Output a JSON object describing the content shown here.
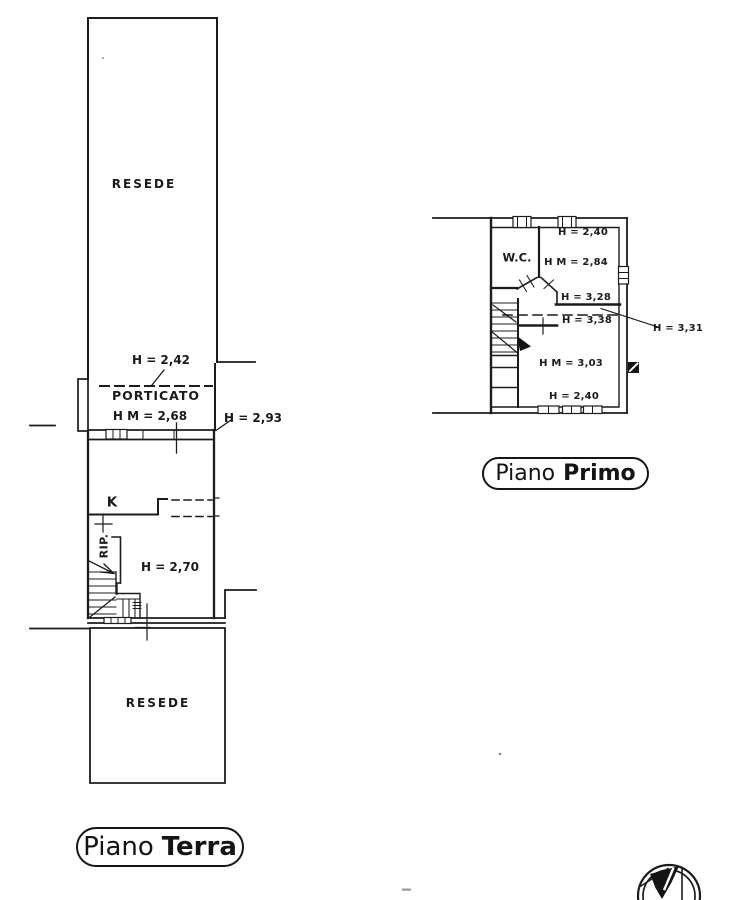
{
  "ground_floor": {
    "resede_top_label": "RESEDE",
    "porticato_height_note": "H = 2,42",
    "porticato_label": "PORTICATO",
    "porticato_mean_height": "H M = 2,68",
    "eaves_height_note": "H = 2,93",
    "kitchen_label": "K",
    "storage_label": "RIP.",
    "room_height": "H = 2,70",
    "resede_bottom_label": "RESEDE",
    "caption": {
      "regular": "Piano",
      "bold": "Terra"
    }
  },
  "first_floor": {
    "wc_label": "W.C.",
    "height_top": "H = 2,40",
    "bedroom_mean_height": "H M = 2,84",
    "height_328": "H = 3,28",
    "height_338": "H = 3,38",
    "height_331": "H = 3,31",
    "living_mean_height": "H M = 3,03",
    "height_bottom": "H = 2,40",
    "caption": {
      "regular": "Piano",
      "bold": "Primo"
    }
  },
  "icons": {
    "north_arrow": "compass-north-symbol"
  },
  "colors": {
    "ink": "#1c1c1c",
    "paper": "#ffffff"
  }
}
